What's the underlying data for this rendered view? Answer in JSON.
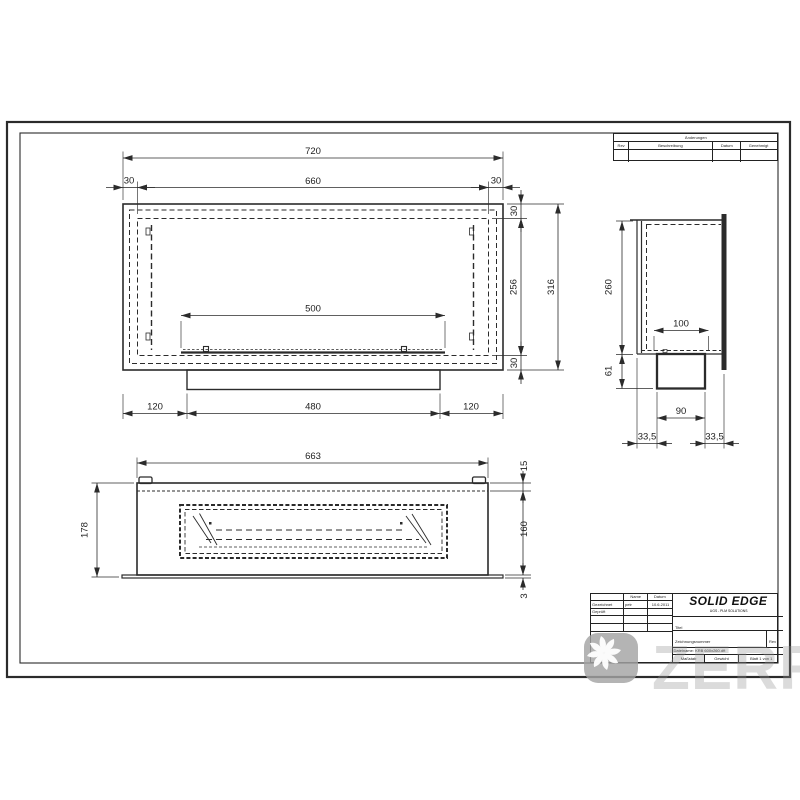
{
  "revision_table": {
    "title": "Änderungen",
    "col_rev": "Rev",
    "col_desc": "Beschreibung",
    "col_date": "Datum",
    "col_approved": "Genehmigt"
  },
  "title_block": {
    "col_name": "Name",
    "col_date": "Datum",
    "row1_label": "Gezeichnet",
    "row1_name": "petr",
    "row1_date": "10.6.2011",
    "row2_label": "Geprüft",
    "logo": "SOLID EDGE",
    "logo_sub": "UGS - PLM SOLUTIONS",
    "title_label": "Titel",
    "dwg_no_label": "Zeichnungsnummer",
    "dwg_no": "A2",
    "rev_label": "Rev",
    "filename": "Dateiname: KRB 600x260.dft",
    "scale_label": "Maßstab",
    "weight_label": "Gewicht",
    "sheet_label": "Blatt 1 von 1"
  },
  "front_view": {
    "d720": "720",
    "d660": "660",
    "d30l": "30",
    "d30r": "30",
    "d500": "500",
    "d30t": "30",
    "d256": "256",
    "d30b": "30",
    "d316": "316",
    "d120l": "120",
    "d480": "480",
    "d120r": "120"
  },
  "side_view": {
    "d260": "260",
    "d100": "100",
    "d61": "61",
    "d90": "90",
    "d335l": "33,5",
    "d335r": "33,5"
  },
  "bottom_view": {
    "d663": "663",
    "d178": "178",
    "d15": "15",
    "d160": "160",
    "d3": "3"
  },
  "watermark": {
    "text": "ZERRE"
  }
}
